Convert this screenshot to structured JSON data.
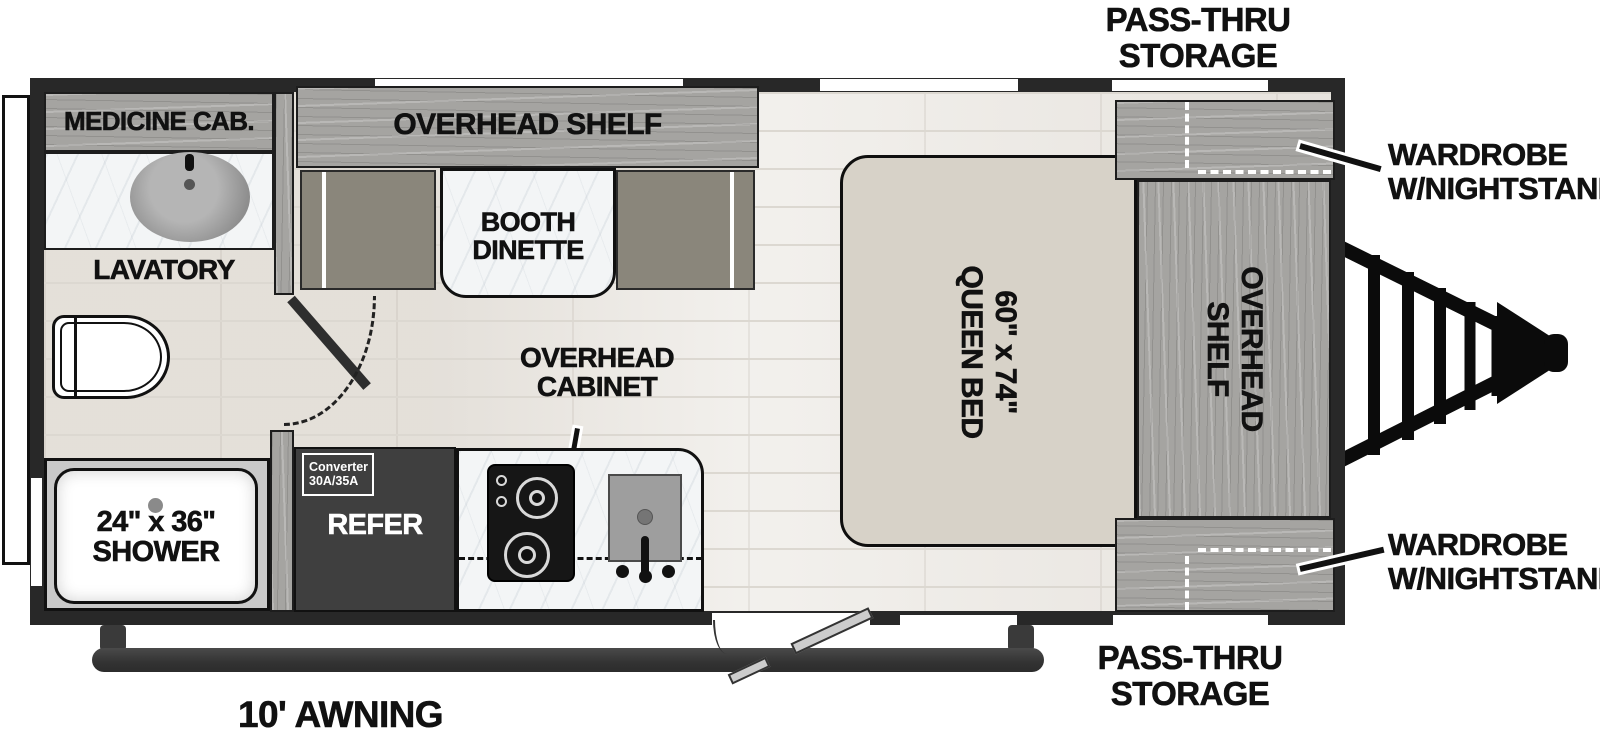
{
  "title": "Travel trailer floor plan",
  "colors": {
    "wall": "#282828",
    "wood": "#a5a4a1",
    "floor": "#edeae5",
    "floor_line": "#dcd8d1",
    "marble": "#f3f5f6",
    "bed": "#d7d2c8",
    "bench": "#8a867b",
    "refer": "#3f3f3f",
    "shower": "#c9c9c9",
    "awning_bar": "#3a3a3a",
    "label": "#111111"
  },
  "labels": {
    "pass_thru_top": {
      "line1": "PASS-THRU",
      "line2": "STORAGE"
    },
    "wardrobe_front": {
      "line1": "WARDROBE",
      "line2": "W/NIGHTSTAND"
    },
    "wardrobe_rear": {
      "line1": "WARDROBE",
      "line2": "W/NIGHTSTAND"
    },
    "pass_thru_bottom": {
      "line1": "PASS-THRU",
      "line2": "STORAGE"
    },
    "awning": "10' AWNING",
    "medicine_cab": "MEDICINE CAB.",
    "lavatory": "LAVATORY",
    "shower": {
      "line1": "24\" x 36\"",
      "line2": "SHOWER"
    },
    "overhead_shelf_galley": "OVERHEAD SHELF",
    "booth_dinette": {
      "line1": "BOOTH",
      "line2": "DINETTE"
    },
    "overhead_cabinet": {
      "line1": "OVERHEAD",
      "line2": "CABINET"
    },
    "refer": "REFER",
    "converter": {
      "line1": "Converter",
      "line2": "30A/35A"
    },
    "queen_bed": {
      "line1": "60\" x 74\"",
      "line2": "QUEEN BED"
    },
    "overhead_shelf_bedroom": {
      "line1": "OVERHEAD",
      "line2": "SHELF"
    }
  }
}
